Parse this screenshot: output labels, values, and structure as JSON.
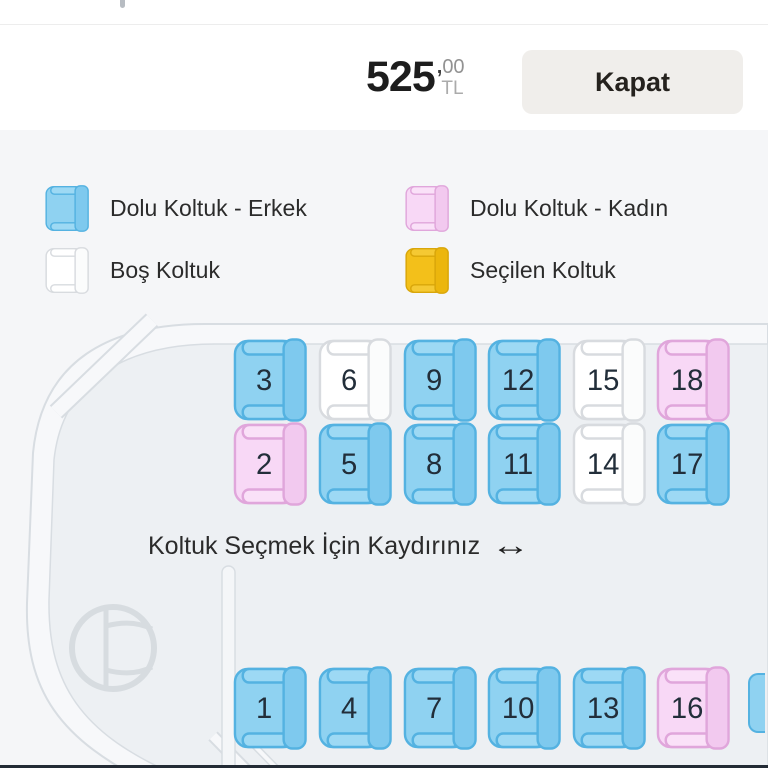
{
  "header": {
    "price": {
      "amount": "525",
      "decimal_separator": ",",
      "decimals": "00",
      "currency": "TL"
    },
    "close_label": "Kapat"
  },
  "legend": {
    "items": [
      {
        "type": "male",
        "label": "Dolu Koltuk - Erkek"
      },
      {
        "type": "female",
        "label": "Dolu Koltuk - Kadın"
      },
      {
        "type": "empty",
        "label": "Boş Koltuk"
      },
      {
        "type": "selected",
        "label": "Seçilen Koltuk"
      }
    ]
  },
  "seat_map": {
    "hint": "Koltuk Seçmek İçin Kaydırınız",
    "hint_arrow": "↔",
    "rows": [
      {
        "seats": [
          {
            "number": "3",
            "status": "male"
          },
          {
            "number": "6",
            "status": "empty"
          },
          {
            "number": "9",
            "status": "male"
          },
          {
            "number": "12",
            "status": "male"
          },
          {
            "number": "15",
            "status": "empty"
          },
          {
            "number": "18",
            "status": "female"
          }
        ]
      },
      {
        "seats": [
          {
            "number": "2",
            "status": "female"
          },
          {
            "number": "5",
            "status": "male"
          },
          {
            "number": "8",
            "status": "male"
          },
          {
            "number": "11",
            "status": "male"
          },
          {
            "number": "14",
            "status": "empty"
          },
          {
            "number": "17",
            "status": "male"
          }
        ]
      },
      {
        "seats": [
          {
            "number": "1",
            "status": "male"
          },
          {
            "number": "4",
            "status": "male"
          },
          {
            "number": "7",
            "status": "male"
          },
          {
            "number": "10",
            "status": "male"
          },
          {
            "number": "13",
            "status": "male"
          },
          {
            "number": "16",
            "status": "female"
          }
        ]
      }
    ],
    "partial_seat": {
      "status": "male"
    }
  },
  "colors": {
    "frame_border": "#F2BC3B",
    "header_bg": "#FFFFFF",
    "close_button_bg": "#F0EEEB",
    "section_bg": "#F5F6F8",
    "bus_fill": "#EDF0F3",
    "bus_band": "#F7F8FA",
    "bus_stroke": "#D8DDE2",
    "seat_number_text": "#222E3A",
    "seat_palette": {
      "male": {
        "body": "#8FD2F1",
        "arm": "#9DD9F4",
        "back": "#7EC9EE",
        "border": "#54B2E1"
      },
      "female": {
        "body": "#F8D8F6",
        "arm": "#FAE1F8",
        "back": "#F2C9EF",
        "border": "#E0A6DB"
      },
      "empty": {
        "body": "#FFFFFF",
        "arm": "#FFFFFF",
        "back": "#FBFCFC",
        "border": "#D8DBDF"
      },
      "selected": {
        "body": "#F3C01A",
        "arm": "#F5C933",
        "back": "#ECB60D",
        "border": "#D9A60A"
      }
    }
  }
}
